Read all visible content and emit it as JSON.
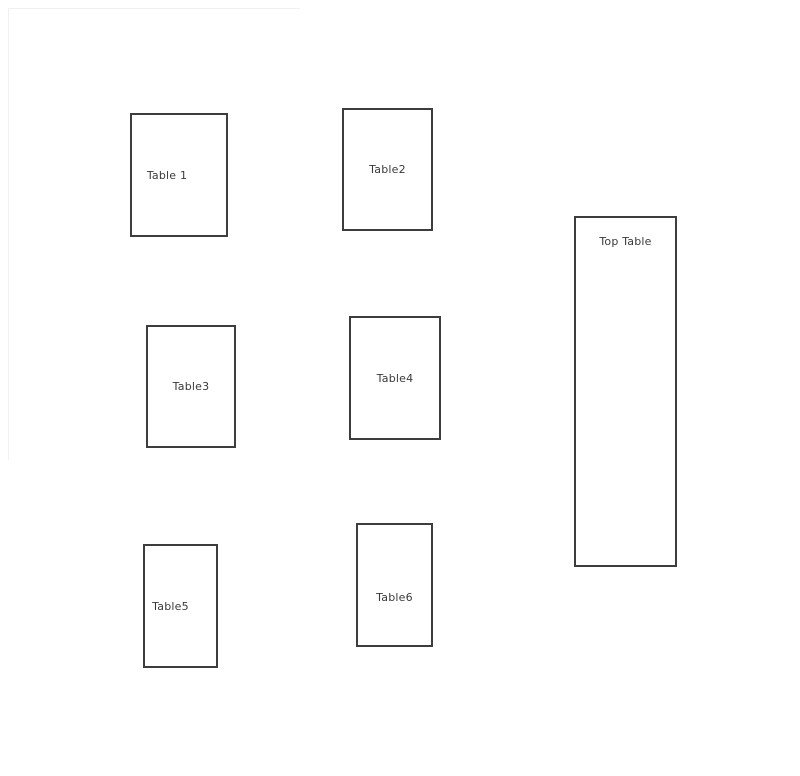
{
  "diagram": {
    "type": "seating-plan",
    "tables": [
      {
        "id": "table-1",
        "label": "Table 1"
      },
      {
        "id": "table-2",
        "label": "Table2"
      },
      {
        "id": "table-3",
        "label": "Table3"
      },
      {
        "id": "table-4",
        "label": "Table4"
      },
      {
        "id": "table-5",
        "label": "Table5"
      },
      {
        "id": "table-6",
        "label": "Table6"
      },
      {
        "id": "top-table",
        "label": "Top Table"
      }
    ],
    "colors": {
      "background": "#ffffff",
      "box_border": "#3d3d3d",
      "label_text": "#3a3a3a",
      "faint_page_line": "#f0f0f0"
    }
  }
}
